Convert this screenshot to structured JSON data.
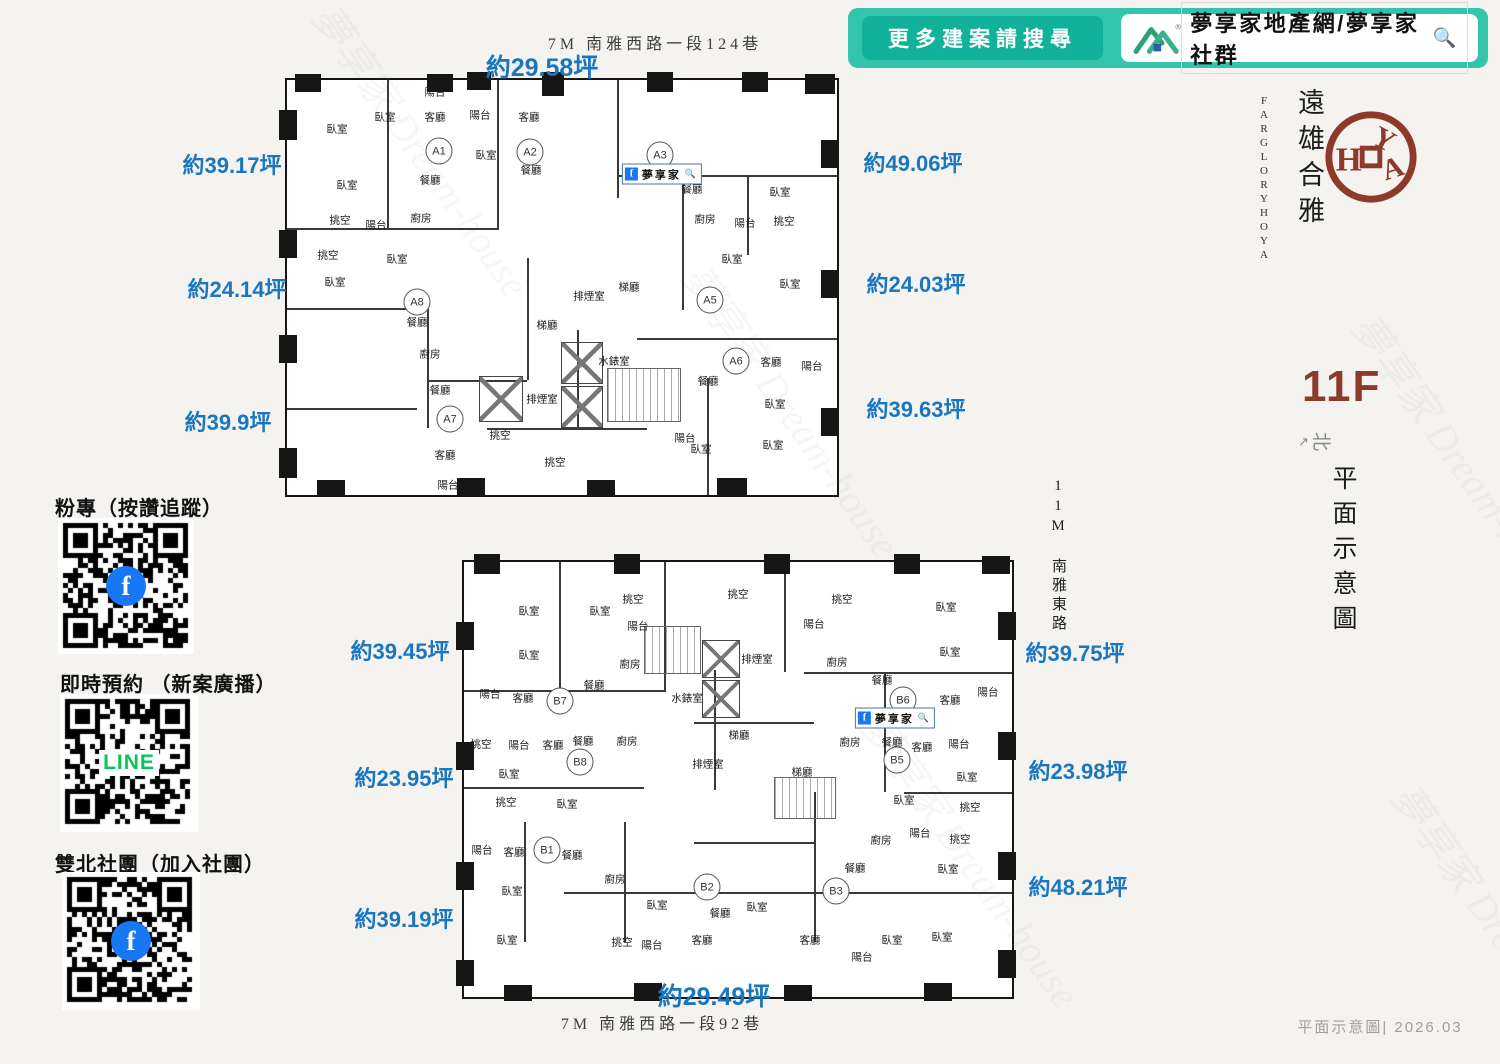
{
  "colors": {
    "background": "#f4f3ef",
    "banner_teal": "#33c5ac",
    "banner_button_teal": "#12b199",
    "area_label_blue": "#1b76c0",
    "brand_red": "#8e3a2b",
    "wall_black": "#161616",
    "facebook_blue": "#1877f2",
    "line_green": "#06c755"
  },
  "banner": {
    "button_label": "更多建案請搜尋",
    "brand_text": "夢享家地產網/夢享家社群",
    "search_icon": "🔍"
  },
  "brand": {
    "cn": "遠雄合雅",
    "en_line1": "FARGLORY",
    "en_line2": "HOYA",
    "seal": "HOYA"
  },
  "floor": {
    "label": "11F",
    "compass": "北",
    "compass_arrow": "↗",
    "caption_vertical": "平面示意圖"
  },
  "footer": {
    "text": "平面示意圖| 2026.03"
  },
  "watermark": {
    "text": "夢享家 Dream-house"
  },
  "roads": {
    "upper_street": {
      "text": "7M 南雅西路一段124巷",
      "x": 655,
      "y": 42
    },
    "lower_street": {
      "text": "7M 南雅西路一段92巷",
      "x": 662,
      "y": 1022
    },
    "east_road": "11M 南雅東路"
  },
  "sidebar": {
    "sections": [
      {
        "heading": "粉專（按讚追蹤）",
        "qr_type": "facebook",
        "overlay": "f"
      },
      {
        "heading": "即時預約 （新案廣播）",
        "qr_type": "line",
        "overlay": "LINE"
      },
      {
        "heading": "雙北社團（加入社團）",
        "qr_type": "facebook",
        "overlay": "f"
      }
    ]
  },
  "plans": [
    {
      "name": "upper",
      "fb": {
        "text": "夢享家",
        "icon": "f",
        "mag": "🔍",
        "x": 375,
        "y": 94
      },
      "areas": [
        {
          "text": "約29.58坪",
          "x": 542,
          "y": 66,
          "size": 25
        },
        {
          "text": "約39.17坪",
          "x": 232,
          "y": 164
        },
        {
          "text": "約24.14坪",
          "x": 237,
          "y": 288
        },
        {
          "text": "約39.9坪",
          "x": 228,
          "y": 421
        },
        {
          "text": "約49.06坪",
          "x": 913,
          "y": 162
        },
        {
          "text": "約24.03坪",
          "x": 916,
          "y": 283
        },
        {
          "text": "約39.63坪",
          "x": 916,
          "y": 408
        }
      ],
      "units": [
        {
          "label": "A1",
          "x": 152,
          "y": 71
        },
        {
          "label": "A2",
          "x": 243,
          "y": 72
        },
        {
          "label": "A3",
          "x": 373,
          "y": 75
        },
        {
          "label": "A5",
          "x": 423,
          "y": 220
        },
        {
          "label": "A6",
          "x": 449,
          "y": 281
        },
        {
          "label": "A7",
          "x": 163,
          "y": 339
        },
        {
          "label": "A8",
          "x": 130,
          "y": 222
        }
      ],
      "rooms": [
        {
          "t": "陽台",
          "x": 148,
          "y": 12
        },
        {
          "t": "臥室",
          "x": 50,
          "y": 49
        },
        {
          "t": "臥室",
          "x": 98,
          "y": 37
        },
        {
          "t": "客廳",
          "x": 148,
          "y": 37
        },
        {
          "t": "陽台",
          "x": 193,
          "y": 35
        },
        {
          "t": "客廳",
          "x": 242,
          "y": 37
        },
        {
          "t": "臥室",
          "x": 199,
          "y": 75
        },
        {
          "t": "餐廳",
          "x": 244,
          "y": 90
        },
        {
          "t": "餐廳",
          "x": 405,
          "y": 109
        },
        {
          "t": "臥室",
          "x": 493,
          "y": 112
        },
        {
          "t": "臥室",
          "x": 60,
          "y": 105
        },
        {
          "t": "餐廳",
          "x": 143,
          "y": 100
        },
        {
          "t": "廚房",
          "x": 134,
          "y": 138
        },
        {
          "t": "陽台",
          "x": 89,
          "y": 145
        },
        {
          "t": "挑空",
          "x": 53,
          "y": 140
        },
        {
          "t": "廚房",
          "x": 418,
          "y": 139
        },
        {
          "t": "陽台",
          "x": 458,
          "y": 143
        },
        {
          "t": "挑空",
          "x": 497,
          "y": 141
        },
        {
          "t": "挑空",
          "x": 41,
          "y": 175
        },
        {
          "t": "臥室",
          "x": 110,
          "y": 179
        },
        {
          "t": "臥室",
          "x": 445,
          "y": 179
        },
        {
          "t": "臥室",
          "x": 503,
          "y": 204
        },
        {
          "t": "臥室",
          "x": 48,
          "y": 202
        },
        {
          "t": "梯廳",
          "x": 342,
          "y": 207
        },
        {
          "t": "排煙室",
          "x": 302,
          "y": 216
        },
        {
          "t": "梯廳",
          "x": 260,
          "y": 245
        },
        {
          "t": "餐廳",
          "x": 130,
          "y": 242
        },
        {
          "t": "廚房",
          "x": 143,
          "y": 274
        },
        {
          "t": "水錶室",
          "x": 327,
          "y": 281
        },
        {
          "t": "餐廳",
          "x": 153,
          "y": 310
        },
        {
          "t": "排煙室",
          "x": 255,
          "y": 319
        },
        {
          "t": "客廳",
          "x": 484,
          "y": 282
        },
        {
          "t": "陽台",
          "x": 525,
          "y": 286
        },
        {
          "t": "餐廳",
          "x": 421,
          "y": 301
        },
        {
          "t": "臥室",
          "x": 488,
          "y": 324
        },
        {
          "t": "客廳",
          "x": 158,
          "y": 375
        },
        {
          "t": "挑空",
          "x": 213,
          "y": 355
        },
        {
          "t": "挑空",
          "x": 268,
          "y": 382
        },
        {
          "t": "臥室",
          "x": 414,
          "y": 369
        },
        {
          "t": "臥室",
          "x": 486,
          "y": 365
        },
        {
          "t": "陽台",
          "x": 161,
          "y": 405
        },
        {
          "t": "陽台",
          "x": 398,
          "y": 358
        }
      ]
    },
    {
      "name": "lower",
      "fb": {
        "text": "夢享家",
        "icon": "f",
        "mag": "🔍",
        "x": 431,
        "y": 156
      },
      "areas": [
        {
          "text": "約39.45坪",
          "x": 400,
          "y": 650
        },
        {
          "text": "約23.95坪",
          "x": 404,
          "y": 777
        },
        {
          "text": "約39.19坪",
          "x": 404,
          "y": 918
        },
        {
          "text": "約39.75坪",
          "x": 1075,
          "y": 652
        },
        {
          "text": "約23.98坪",
          "x": 1078,
          "y": 770
        },
        {
          "text": "約48.21坪",
          "x": 1078,
          "y": 886
        },
        {
          "text": "約29.49坪",
          "x": 714,
          "y": 995,
          "size": 25
        }
      ],
      "units": [
        {
          "label": "B7",
          "x": 96,
          "y": 139
        },
        {
          "label": "B8",
          "x": 116,
          "y": 200
        },
        {
          "label": "B1",
          "x": 83,
          "y": 288
        },
        {
          "label": "B2",
          "x": 243,
          "y": 325
        },
        {
          "label": "B3",
          "x": 372,
          "y": 329
        },
        {
          "label": "B5",
          "x": 433,
          "y": 198
        },
        {
          "label": "B6",
          "x": 439,
          "y": 138
        }
      ],
      "rooms": [
        {
          "t": "臥室",
          "x": 65,
          "y": 49
        },
        {
          "t": "臥室",
          "x": 136,
          "y": 49
        },
        {
          "t": "挑空",
          "x": 169,
          "y": 37
        },
        {
          "t": "挑空",
          "x": 274,
          "y": 32
        },
        {
          "t": "挑空",
          "x": 378,
          "y": 37
        },
        {
          "t": "陽台",
          "x": 174,
          "y": 64
        },
        {
          "t": "陽台",
          "x": 350,
          "y": 62
        },
        {
          "t": "臥室",
          "x": 482,
          "y": 45
        },
        {
          "t": "臥室",
          "x": 486,
          "y": 90
        },
        {
          "t": "臥室",
          "x": 65,
          "y": 93
        },
        {
          "t": "廚房",
          "x": 166,
          "y": 102
        },
        {
          "t": "排煙室",
          "x": 293,
          "y": 97
        },
        {
          "t": "廚房",
          "x": 373,
          "y": 100
        },
        {
          "t": "餐廳",
          "x": 130,
          "y": 123
        },
        {
          "t": "客廳",
          "x": 59,
          "y": 136
        },
        {
          "t": "陽台",
          "x": 26,
          "y": 132
        },
        {
          "t": "水錶室",
          "x": 223,
          "y": 136
        },
        {
          "t": "餐廳",
          "x": 418,
          "y": 118
        },
        {
          "t": "客廳",
          "x": 486,
          "y": 138
        },
        {
          "t": "陽台",
          "x": 524,
          "y": 130
        },
        {
          "t": "梯廳",
          "x": 275,
          "y": 173
        },
        {
          "t": "挑空",
          "x": 17,
          "y": 182
        },
        {
          "t": "陽台",
          "x": 55,
          "y": 183
        },
        {
          "t": "客廳",
          "x": 89,
          "y": 183
        },
        {
          "t": "餐廳",
          "x": 119,
          "y": 179
        },
        {
          "t": "廚房",
          "x": 163,
          "y": 179
        },
        {
          "t": "排煙室",
          "x": 244,
          "y": 202
        },
        {
          "t": "梯廳",
          "x": 338,
          "y": 210
        },
        {
          "t": "廚房",
          "x": 386,
          "y": 180
        },
        {
          "t": "餐廳",
          "x": 428,
          "y": 180
        },
        {
          "t": "客廳",
          "x": 458,
          "y": 185
        },
        {
          "t": "陽台",
          "x": 495,
          "y": 182
        },
        {
          "t": "臥室",
          "x": 45,
          "y": 212
        },
        {
          "t": "臥室",
          "x": 503,
          "y": 215
        },
        {
          "t": "臥室",
          "x": 440,
          "y": 238
        },
        {
          "t": "挑空",
          "x": 506,
          "y": 245
        },
        {
          "t": "挑空",
          "x": 42,
          "y": 240
        },
        {
          "t": "臥室",
          "x": 103,
          "y": 242
        },
        {
          "t": "陽台",
          "x": 456,
          "y": 271
        },
        {
          "t": "挑空",
          "x": 496,
          "y": 277
        },
        {
          "t": "廚房",
          "x": 417,
          "y": 278
        },
        {
          "t": "陽台",
          "x": 18,
          "y": 288
        },
        {
          "t": "客廳",
          "x": 50,
          "y": 290
        },
        {
          "t": "餐廳",
          "x": 108,
          "y": 293
        },
        {
          "t": "廚房",
          "x": 151,
          "y": 317
        },
        {
          "t": "臥室",
          "x": 48,
          "y": 329
        },
        {
          "t": "餐廳",
          "x": 391,
          "y": 306
        },
        {
          "t": "臥室",
          "x": 484,
          "y": 307
        },
        {
          "t": "臥室",
          "x": 193,
          "y": 343
        },
        {
          "t": "餐廳",
          "x": 256,
          "y": 351
        },
        {
          "t": "臥室",
          "x": 293,
          "y": 345
        },
        {
          "t": "客廳",
          "x": 238,
          "y": 378
        },
        {
          "t": "挑空",
          "x": 158,
          "y": 380
        },
        {
          "t": "陽台",
          "x": 188,
          "y": 383
        },
        {
          "t": "臥室",
          "x": 43,
          "y": 378
        },
        {
          "t": "客廳",
          "x": 346,
          "y": 378
        },
        {
          "t": "臥室",
          "x": 428,
          "y": 378
        },
        {
          "t": "臥室",
          "x": 478,
          "y": 375
        },
        {
          "t": "陽台",
          "x": 398,
          "y": 395
        }
      ]
    }
  ]
}
